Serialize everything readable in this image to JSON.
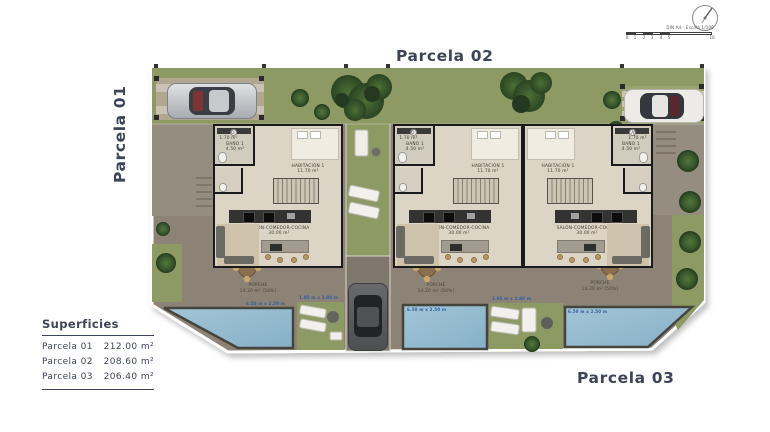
{
  "titles": {
    "parcela01": "Parcela 01",
    "parcela02": "Parcela 02",
    "parcela03": "Parcela 03"
  },
  "legend": {
    "title": "Superficies",
    "rows": [
      {
        "label": "Parcela 01",
        "value": "212.00 m²"
      },
      {
        "label": "Parcela 02",
        "value": "208.60 m²"
      },
      {
        "label": "Parcela 03",
        "value": "206.40 m²"
      }
    ]
  },
  "scalebar": {
    "caption": "DIN A4 - Escala 1/100",
    "ticks": [
      "0",
      "1",
      "2",
      "3",
      "4",
      "5",
      "10"
    ]
  },
  "rooms": {
    "bano": "BAÑO 1",
    "bano_area": "4.50 m²",
    "aseo": "ASEO",
    "aseo_area": "1.70 m²",
    "habitacion": "HABITACIÓN 1",
    "habitacion_area": "11.70 m²",
    "salon": "SALÓN-COMEDOR-COCINA",
    "salon_area": "30.00 m²",
    "porche": "PORCHE",
    "porche_area": "14.20 m² (50%)",
    "pool_dim": "6.50 m x 2.50 m",
    "patio_dim": "1.95 m x 2.80 m"
  },
  "colors": {
    "title_text": "#3e4457",
    "grass": "#8e9a64",
    "terrace": "#8c8376",
    "pool": "#96bcd2",
    "house_floor": "#dcd4c5",
    "wall": "#1a1a1c",
    "dim_label": "#2d5d9e"
  }
}
